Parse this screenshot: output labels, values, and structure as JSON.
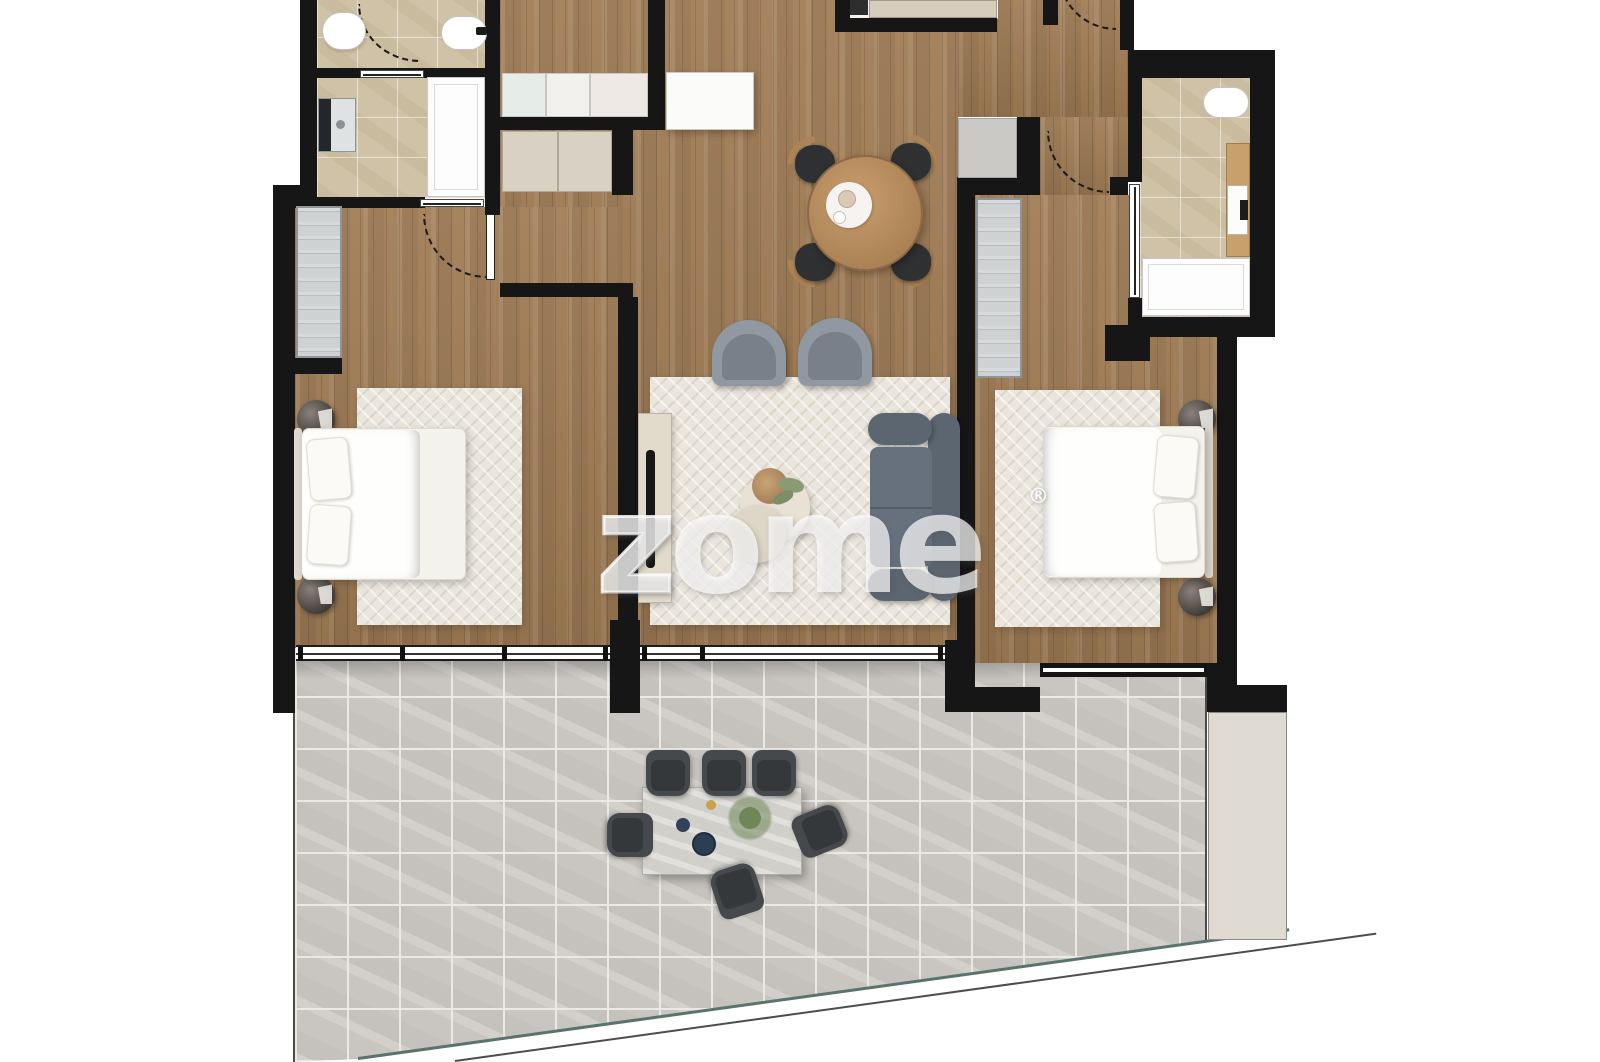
{
  "watermark": {
    "z1": "z",
    "rest": "zome",
    "mark": "®"
  },
  "palette": {
    "wall": "#161616",
    "wood-a": "#a6845f",
    "wood-b": "#94734f",
    "tile-beige": "#cfc2a6",
    "terr": "#c9c6c1",
    "terr-grout": "#ebe9e6",
    "rug": "#eae6dd",
    "sofa": "#5c6670",
    "wm": "rgba(255,255,255,0.70)"
  },
  "rooms": [
    {
      "name": "bathroom-top-left"
    },
    {
      "name": "kitchen"
    },
    {
      "name": "dining-area"
    },
    {
      "name": "living-room"
    },
    {
      "name": "bedroom-left"
    },
    {
      "name": "bedroom-right"
    },
    {
      "name": "bathroom-top-right"
    },
    {
      "name": "entry-hall"
    },
    {
      "name": "terrace"
    }
  ]
}
